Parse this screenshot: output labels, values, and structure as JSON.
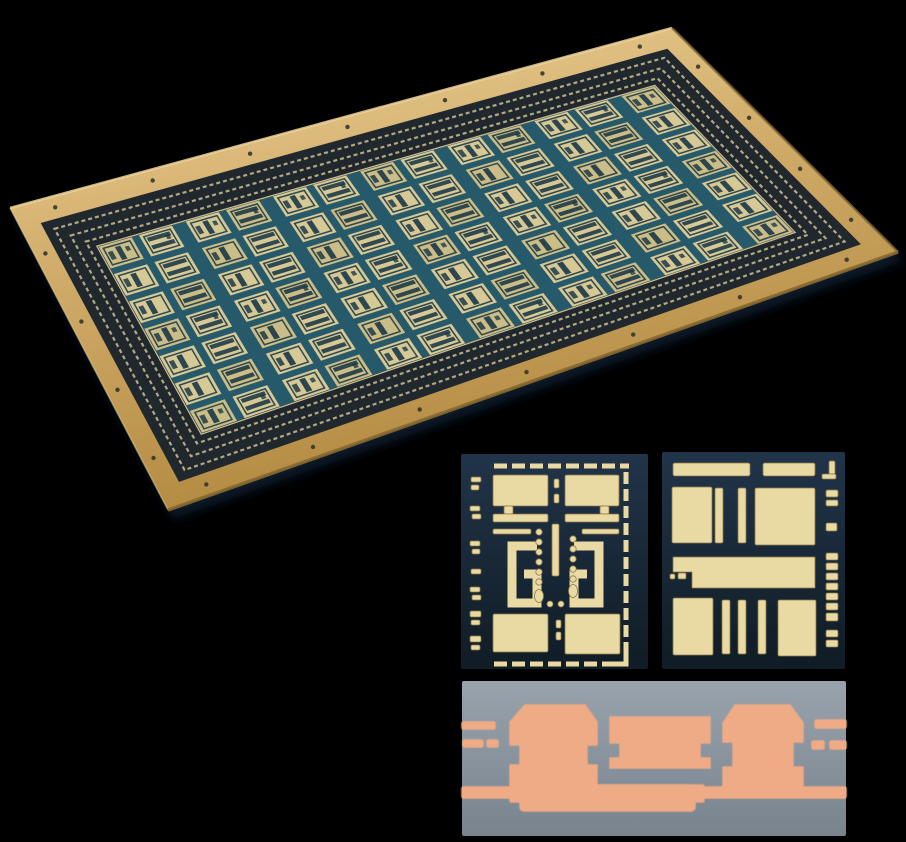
{
  "figure": {
    "background": "black",
    "items": [
      {
        "id": "pcb-panel",
        "label": "angled photo of gold-plated PCB panel with repeating etched circuit dies"
      },
      {
        "id": "die-left",
        "label": "close-up photo of circuit die with dashed guard ring, coupled hooks and via dots"
      },
      {
        "id": "die-right",
        "label": "close-up photo of circuit die with solid pads and bars"
      },
      {
        "id": "cross-section",
        "label": "copper plating cross-section micrograph with castellated pillars"
      }
    ]
  },
  "palette": {
    "black": "#000000",
    "gold": "#d2ad6b",
    "gold_light": "#eed59c",
    "gold_dark": "#b1883f",
    "gold_edge": "#8a6a30",
    "maze_bg": "#20282d",
    "maze_tick": "#cdc094",
    "street": "#26596a",
    "field_line": "#d8cc9e",
    "cell": "#d6c996",
    "cell_alt": "#cbbd87",
    "cell_detail": "#1e3a46",
    "drill": "#35352a",
    "chip_bg_top": "#213449",
    "chip_bg_bottom": "#101c26",
    "metal": "#e9d9a3",
    "metal_edge": "#8d7a45",
    "xsec_top": "#9aa3ac",
    "xsec_bottom": "#78838e",
    "copper": "#eeab85",
    "copper_edge": "#c08060",
    "shadow": "#12304d"
  },
  "panel": {
    "corners": {
      "tl": [
        10,
        208
      ],
      "tr": [
        672,
        28
      ],
      "br": [
        898,
        252
      ],
      "bl": [
        168,
        510
      ]
    },
    "band": {
      "u0": 0.03,
      "v0": 0.068,
      "u1": 0.088,
      "v1": 0.185
    },
    "grid": {
      "cols": 13,
      "rows": 7,
      "thin_gap": 0.22,
      "wide_gap": 0.42,
      "row_gap": 0.26
    },
    "texture_rings": [
      0.24,
      0.52,
      0.78
    ],
    "drills": {
      "top": 7,
      "bottom": 7,
      "left": 4,
      "right": 4
    }
  },
  "die_left": {
    "x": 461,
    "y": 454,
    "w": 187,
    "h": 215,
    "shapes": [
      {
        "t": "dl",
        "x1": 33,
        "y1": 12,
        "x2": 168,
        "y2": 12,
        "sw": 5,
        "da": "13 5"
      },
      {
        "t": "dl",
        "x1": 33,
        "y1": 210,
        "x2": 160,
        "y2": 210,
        "sw": 5,
        "da": "13 5"
      },
      {
        "t": "dl",
        "x1": 165,
        "y1": 18,
        "x2": 165,
        "y2": 198,
        "sw": 5,
        "da": "12 5"
      },
      {
        "t": "pl",
        "pts": "165,198 165,210 152,210",
        "sw": 5
      },
      {
        "t": "r",
        "x": 10,
        "y": 23,
        "w": 10,
        "h": 5
      },
      {
        "t": "r",
        "x": 10,
        "y": 31,
        "w": 8,
        "h": 5
      },
      {
        "t": "r",
        "x": 9,
        "y": 52,
        "w": 10,
        "h": 5
      },
      {
        "t": "r",
        "x": 11,
        "y": 60,
        "w": 9,
        "h": 5
      },
      {
        "t": "r",
        "x": 9,
        "y": 87,
        "w": 10,
        "h": 5
      },
      {
        "t": "r",
        "x": 11,
        "y": 95,
        "w": 8,
        "h": 5
      },
      {
        "t": "r",
        "x": 10,
        "y": 115,
        "w": 10,
        "h": 5
      },
      {
        "t": "r",
        "x": 9,
        "y": 133,
        "w": 10,
        "h": 5
      },
      {
        "t": "r",
        "x": 11,
        "y": 141,
        "w": 9,
        "h": 5
      },
      {
        "t": "r",
        "x": 9,
        "y": 157,
        "w": 11,
        "h": 6
      },
      {
        "t": "r",
        "x": 10,
        "y": 166,
        "w": 9,
        "h": 5
      },
      {
        "t": "r",
        "x": 9,
        "y": 182,
        "w": 11,
        "h": 6
      },
      {
        "t": "r",
        "x": 10,
        "y": 191,
        "w": 9,
        "h": 5
      },
      {
        "t": "r",
        "x": 32,
        "y": 21,
        "w": 55,
        "h": 31
      },
      {
        "t": "r",
        "x": 104,
        "y": 21,
        "w": 54,
        "h": 31
      },
      {
        "t": "r",
        "x": 43,
        "y": 52,
        "w": 9,
        "h": 8
      },
      {
        "t": "r",
        "x": 139,
        "y": 52,
        "w": 9,
        "h": 8
      },
      {
        "t": "r",
        "x": 32,
        "y": 60,
        "w": 55,
        "h": 8
      },
      {
        "t": "r",
        "x": 104,
        "y": 60,
        "w": 54,
        "h": 8
      },
      {
        "t": "r",
        "x": 32,
        "y": 75,
        "w": 38,
        "h": 5
      },
      {
        "t": "r",
        "x": 121,
        "y": 75,
        "w": 37,
        "h": 5
      },
      {
        "t": "r",
        "x": 93,
        "y": 25,
        "w": 5,
        "h": 9
      },
      {
        "t": "r",
        "x": 93,
        "y": 40,
        "w": 5,
        "h": 9
      },
      {
        "t": "r",
        "x": 91,
        "y": 70,
        "w": 7,
        "h": 52
      },
      {
        "t": "pl",
        "pts": "76,92 51,92 51,149 76,149 76,120 63,120",
        "sw": 9
      },
      {
        "t": "pl",
        "pts": "113,92 138,92 138,149 113,149 113,120 126,120",
        "sw": 9
      },
      {
        "t": "c",
        "cx": 78,
        "cy": 78,
        "r": 3.2
      },
      {
        "t": "c",
        "cx": 78,
        "cy": 88,
        "r": 3.2
      },
      {
        "t": "c",
        "cx": 78,
        "cy": 98,
        "r": 3.2
      },
      {
        "t": "c",
        "cx": 78,
        "cy": 108,
        "r": 3.2
      },
      {
        "t": "c",
        "cx": 78,
        "cy": 118,
        "r": 3.2
      },
      {
        "t": "c",
        "cx": 78,
        "cy": 128,
        "r": 3.2
      },
      {
        "t": "e",
        "cx": 78,
        "cy": 142,
        "rx": 4.5,
        "ry": 6.5
      },
      {
        "t": "c",
        "cx": 112,
        "cy": 85,
        "r": 3.2
      },
      {
        "t": "c",
        "cx": 112,
        "cy": 95,
        "r": 3.2
      },
      {
        "t": "c",
        "cx": 112,
        "cy": 105,
        "r": 3.2
      },
      {
        "t": "c",
        "cx": 112,
        "cy": 115,
        "r": 3.2
      },
      {
        "t": "c",
        "cx": 112,
        "cy": 125,
        "r": 3.2
      },
      {
        "t": "e",
        "cx": 112,
        "cy": 137,
        "rx": 4.5,
        "ry": 6.5
      },
      {
        "t": "c",
        "cx": 89,
        "cy": 150,
        "r": 3
      },
      {
        "t": "c",
        "cx": 100,
        "cy": 150,
        "r": 3
      },
      {
        "t": "r",
        "x": 32,
        "y": 160,
        "w": 55,
        "h": 38
      },
      {
        "t": "r",
        "x": 104,
        "y": 160,
        "w": 55,
        "h": 40
      },
      {
        "t": "r",
        "x": 95,
        "y": 166,
        "w": 5,
        "h": 8
      },
      {
        "t": "r",
        "x": 95,
        "y": 178,
        "w": 5,
        "h": 8
      }
    ]
  },
  "die_right": {
    "x": 662,
    "y": 452,
    "w": 183,
    "h": 217,
    "shapes": [
      {
        "t": "r",
        "x": 11,
        "y": 11,
        "w": 77,
        "h": 13,
        "rx": 2
      },
      {
        "t": "r",
        "x": 101,
        "y": 11,
        "w": 52,
        "h": 13,
        "rx": 2
      },
      {
        "t": "r",
        "x": 167,
        "y": 9,
        "w": 6,
        "h": 13
      },
      {
        "t": "r",
        "x": 160,
        "y": 22,
        "w": 14,
        "h": 5
      },
      {
        "t": "r",
        "x": 164,
        "y": 38,
        "w": 12,
        "h": 7
      },
      {
        "t": "r",
        "x": 164,
        "y": 48,
        "w": 12,
        "h": 6
      },
      {
        "t": "r",
        "x": 164,
        "y": 71,
        "w": 11,
        "h": 8
      },
      {
        "t": "r",
        "x": 164,
        "y": 101,
        "w": 12,
        "h": 7
      },
      {
        "t": "r",
        "x": 164,
        "y": 111,
        "w": 12,
        "h": 7
      },
      {
        "t": "r",
        "x": 164,
        "y": 121,
        "w": 12,
        "h": 7
      },
      {
        "t": "r",
        "x": 164,
        "y": 131,
        "w": 12,
        "h": 7
      },
      {
        "t": "r",
        "x": 164,
        "y": 141,
        "w": 12,
        "h": 7
      },
      {
        "t": "r",
        "x": 164,
        "y": 151,
        "w": 12,
        "h": 7
      },
      {
        "t": "r",
        "x": 164,
        "y": 161,
        "w": 12,
        "h": 8
      },
      {
        "t": "r",
        "x": 164,
        "y": 178,
        "w": 12,
        "h": 7
      },
      {
        "t": "r",
        "x": 164,
        "y": 188,
        "w": 12,
        "h": 7
      },
      {
        "t": "r",
        "x": 10,
        "y": 35,
        "w": 40,
        "h": 56
      },
      {
        "t": "r",
        "x": 53,
        "y": 36,
        "w": 8,
        "h": 55
      },
      {
        "t": "r",
        "x": 76,
        "y": 36,
        "w": 8,
        "h": 55
      },
      {
        "t": "r",
        "x": 93,
        "y": 36,
        "w": 60,
        "h": 57
      },
      {
        "t": "p",
        "pts": "11,105 153,105 153,136 30,136 30,120 11,120"
      },
      {
        "t": "r",
        "x": 8,
        "y": 122,
        "w": 5,
        "h": 5
      },
      {
        "t": "r",
        "x": 16,
        "y": 121,
        "w": 8,
        "h": 6
      },
      {
        "t": "r",
        "x": 11,
        "y": 146,
        "w": 40,
        "h": 57
      },
      {
        "t": "r",
        "x": 60,
        "y": 148,
        "w": 8,
        "h": 54
      },
      {
        "t": "r",
        "x": 76,
        "y": 148,
        "w": 8,
        "h": 54
      },
      {
        "t": "r",
        "x": 96,
        "y": 148,
        "w": 8,
        "h": 54
      },
      {
        "t": "r",
        "x": 116,
        "y": 148,
        "w": 38,
        "h": 56
      }
    ]
  },
  "cross_section": {
    "x": 462,
    "y": 681,
    "w": 384,
    "h": 155,
    "shapes": [
      {
        "t": "r",
        "x": 0,
        "y": 41,
        "w": 33,
        "h": 7
      },
      {
        "t": "r",
        "x": 1,
        "y": 59,
        "w": 20,
        "h": 7
      },
      {
        "t": "r",
        "x": 25,
        "y": 59,
        "w": 11,
        "h": 7
      },
      {
        "t": "r",
        "x": 0,
        "y": 106,
        "w": 384,
        "h": 11
      },
      {
        "t": "r",
        "x": 48,
        "y": 104,
        "w": 194,
        "h": 17
      },
      {
        "t": "r",
        "x": 58,
        "y": 104,
        "w": 175,
        "h": 26,
        "rx": 4
      },
      {
        "t": "p",
        "pts": "63,24 123,24 135,41 135,64 125,64 125,84 135,84 135,110 48,110 48,84 58,84 58,64 48,64 48,41"
      },
      {
        "t": "p",
        "pts": "148,36 248,36 248,62 238,62 238,77 248,77 248,87 148,87 148,77 158,77 158,62 148,62"
      },
      {
        "t": "p",
        "pts": "273,24 328,24 341,42 341,61 331,61 331,86 341,86 341,110 261,110 261,86 271,86 271,61 261,61 261,42"
      },
      {
        "t": "r",
        "x": 353,
        "y": 39,
        "w": 31,
        "h": 8
      },
      {
        "t": "r",
        "x": 350,
        "y": 60,
        "w": 12,
        "h": 8
      },
      {
        "t": "r",
        "x": 368,
        "y": 60,
        "w": 16,
        "h": 8
      }
    ]
  }
}
